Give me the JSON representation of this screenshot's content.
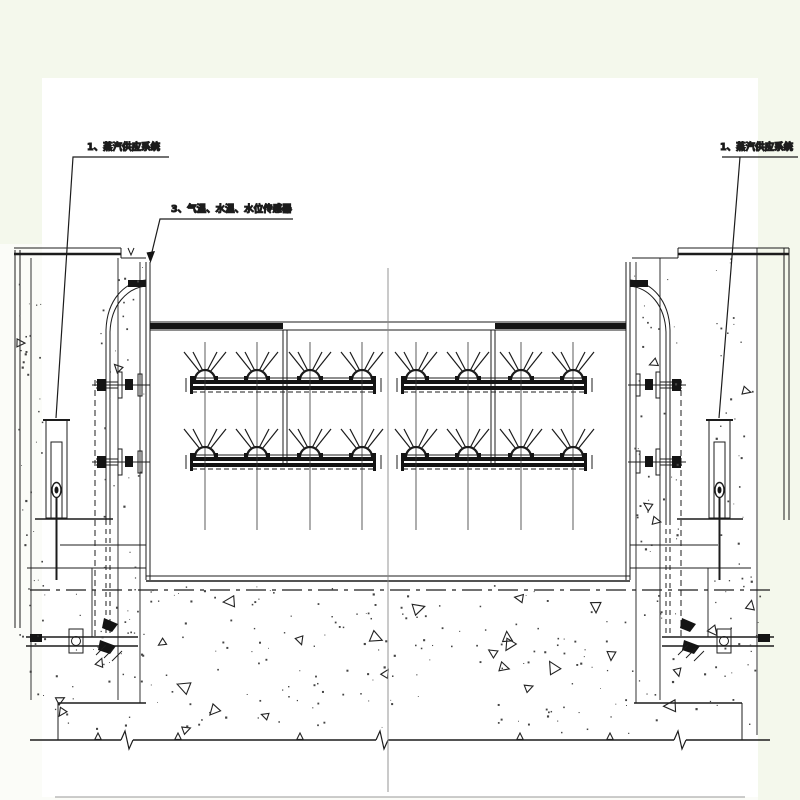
{
  "drawing": {
    "type": "engineering-section-drawing",
    "labels": {
      "steam_left": "1、蒸汽供应系统",
      "sensors": "3、气温、水温、水位传感器",
      "steam_right": "1、蒸汽供应系统"
    },
    "colors": {
      "background": "#f4f8ec",
      "canvas": "#fbfcf8",
      "paper": "#ffffff",
      "line": "#1c1c1c"
    }
  }
}
